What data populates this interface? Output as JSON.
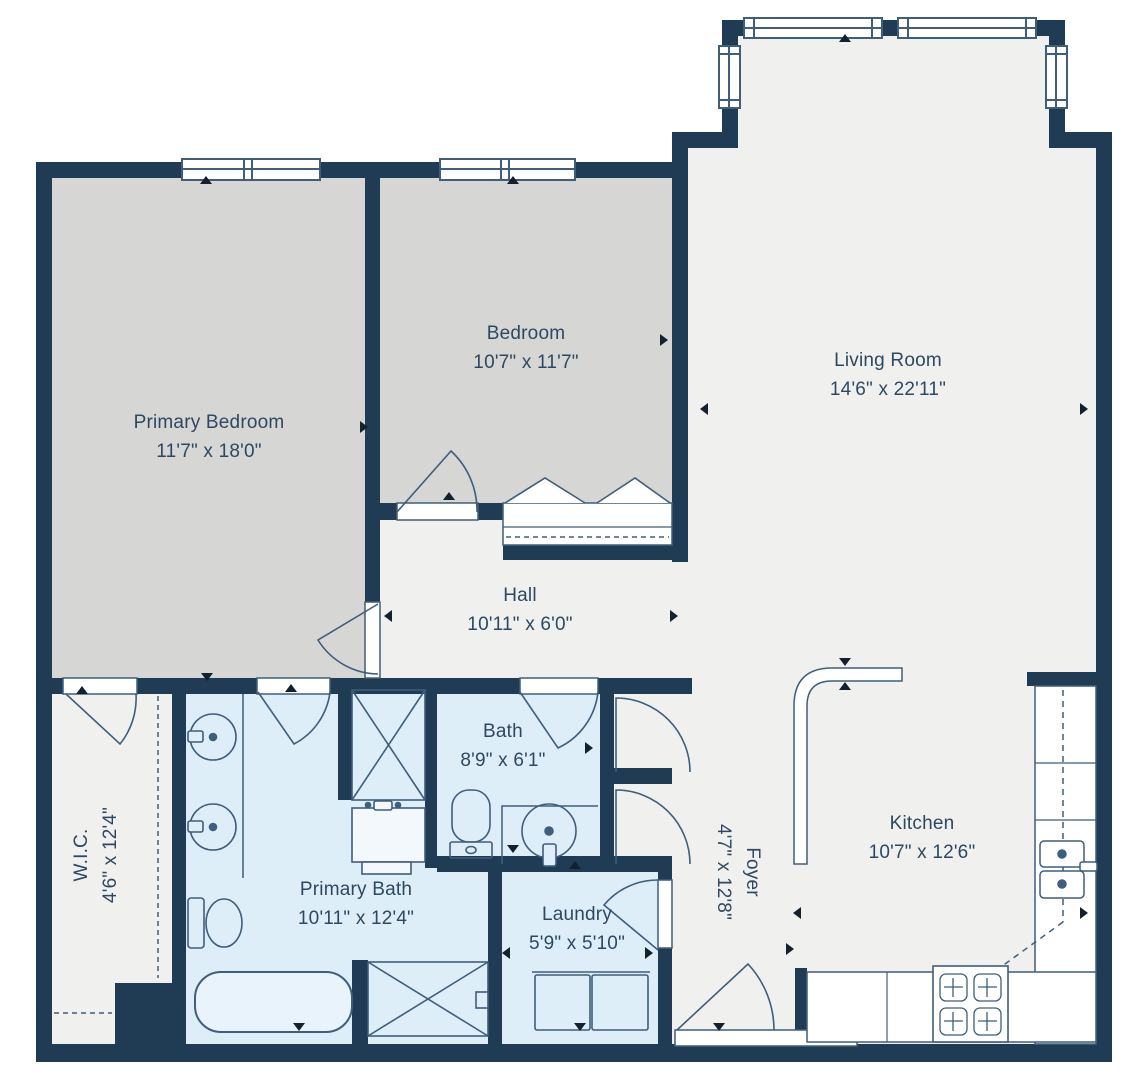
{
  "rooms": {
    "primary_bedroom": {
      "name": "Primary Bedroom",
      "dimensions": "11'7\" x 18'0\""
    },
    "bedroom": {
      "name": "Bedroom",
      "dimensions": "10'7\" x 11'7\""
    },
    "living_room": {
      "name": "Living Room",
      "dimensions": "14'6\" x 22'11\""
    },
    "hall": {
      "name": "Hall",
      "dimensions": "10'11\" x 6'0\""
    },
    "bath": {
      "name": "Bath",
      "dimensions": "8'9\" x 6'1\""
    },
    "wic": {
      "name": "W.I.C.",
      "dimensions": "4'6\" x 12'4\""
    },
    "primary_bath": {
      "name": "Primary Bath",
      "dimensions": "10'11\" x 12'4\""
    },
    "laundry": {
      "name": "Laundry",
      "dimensions": "5'9\" x 5'10\""
    },
    "foyer": {
      "name": "Foyer",
      "dimensions": "4'7\" x 12'8\""
    },
    "kitchen": {
      "name": "Kitchen",
      "dimensions": "10'7\" x 12'6\""
    }
  },
  "colors": {
    "wall": "#203c55",
    "floor_light": "#f0f0ee",
    "floor_bedroom": "#d6d6d4",
    "floor_bath": "#ddeef8",
    "fixture_line": "#3f5e7b",
    "label_text": "#2d4961"
  }
}
